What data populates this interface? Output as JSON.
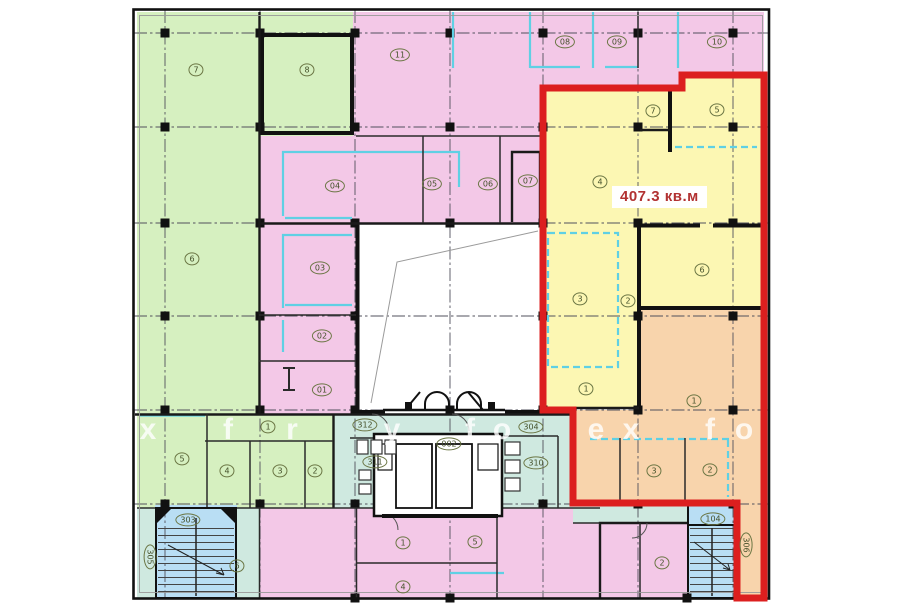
{
  "plan": {
    "title": "floor-plan",
    "area_highlight": {
      "text": "407.3 кв.м",
      "value": "407.3",
      "unit": "кв.м"
    }
  },
  "zones": [
    {
      "name": "green-offices",
      "color": "#d6f0c0"
    },
    {
      "name": "pink-offices",
      "color": "#f3c8e7"
    },
    {
      "name": "yellow-highlight",
      "color": "#fcf7b3"
    },
    {
      "name": "orange-highlight",
      "color": "#f8d4ac"
    },
    {
      "name": "teal-corridor",
      "color": "#cfe9e0"
    },
    {
      "name": "blue-stairwell",
      "color": "#b9def4"
    },
    {
      "name": "highlight-outline",
      "color": "#dc1f1f"
    },
    {
      "name": "partition-lines",
      "color": "#5fd0e4"
    }
  ],
  "rooms": [
    {
      "label": "7",
      "x": 196,
      "y": 70,
      "zone": "green"
    },
    {
      "label": "8",
      "x": 307,
      "y": 70,
      "zone": "green"
    },
    {
      "label": "6",
      "x": 192,
      "y": 259,
      "zone": "green"
    },
    {
      "label": "11",
      "x": 400,
      "y": 55,
      "zone": "pink"
    },
    {
      "label": "08",
      "x": 565,
      "y": 42,
      "zone": "pink"
    },
    {
      "label": "09",
      "x": 617,
      "y": 42,
      "zone": "pink"
    },
    {
      "label": "10",
      "x": 717,
      "y": 42,
      "zone": "pink"
    },
    {
      "label": "04",
      "x": 335,
      "y": 186,
      "zone": "pink"
    },
    {
      "label": "05",
      "x": 432,
      "y": 184,
      "zone": "pink"
    },
    {
      "label": "06",
      "x": 488,
      "y": 184,
      "zone": "pink"
    },
    {
      "label": "07",
      "x": 528,
      "y": 181,
      "zone": "pink"
    },
    {
      "label": "03",
      "x": 320,
      "y": 268,
      "zone": "pink"
    },
    {
      "label": "02",
      "x": 322,
      "y": 336,
      "zone": "pink"
    },
    {
      "label": "01",
      "x": 322,
      "y": 390,
      "zone": "pink"
    },
    {
      "label": "4",
      "x": 600,
      "y": 182,
      "zone": "yellow"
    },
    {
      "label": "7",
      "x": 653,
      "y": 111,
      "zone": "yellow"
    },
    {
      "label": "5",
      "x": 717,
      "y": 110,
      "zone": "yellow"
    },
    {
      "label": "6",
      "x": 702,
      "y": 270,
      "zone": "yellow"
    },
    {
      "label": "3",
      "x": 580,
      "y": 299,
      "zone": "yellow"
    },
    {
      "label": "2",
      "x": 628,
      "y": 301,
      "zone": "yellow"
    },
    {
      "label": "1",
      "x": 586,
      "y": 389,
      "zone": "yellow"
    },
    {
      "label": "1",
      "x": 694,
      "y": 401,
      "zone": "orange"
    },
    {
      "label": "3",
      "x": 654,
      "y": 471,
      "zone": "orange"
    },
    {
      "label": "2",
      "x": 710,
      "y": 470,
      "zone": "orange"
    },
    {
      "label": "1",
      "x": 268,
      "y": 427,
      "zone": "green"
    },
    {
      "label": "5",
      "x": 182,
      "y": 459,
      "zone": "green"
    },
    {
      "label": "4",
      "x": 227,
      "y": 471,
      "zone": "green"
    },
    {
      "label": "3",
      "x": 280,
      "y": 471,
      "zone": "green"
    },
    {
      "label": "2",
      "x": 315,
      "y": 471,
      "zone": "green"
    },
    {
      "label": "312",
      "x": 365,
      "y": 425,
      "zone": "teal"
    },
    {
      "label": "304",
      "x": 531,
      "y": 427,
      "zone": "teal"
    },
    {
      "label": "002",
      "x": 449,
      "y": 444,
      "zone": "teal"
    },
    {
      "label": "311",
      "x": 375,
      "y": 462,
      "zone": "teal"
    },
    {
      "label": "310",
      "x": 536,
      "y": 463,
      "zone": "teal"
    },
    {
      "label": "303",
      "x": 188,
      "y": 520,
      "zone": "stair"
    },
    {
      "label": "104",
      "x": 713,
      "y": 519,
      "zone": "stair"
    },
    {
      "label": "305",
      "x": 150,
      "y": 557,
      "zone": "teal",
      "rot": 90
    },
    {
      "label": "306",
      "x": 746,
      "y": 545,
      "zone": "orange",
      "rot": 90
    },
    {
      "label": "6",
      "x": 237,
      "y": 566,
      "zone": "pink"
    },
    {
      "label": "1",
      "x": 403,
      "y": 543,
      "zone": "pink"
    },
    {
      "label": "5",
      "x": 475,
      "y": 542,
      "zone": "pink"
    },
    {
      "label": "4",
      "x": 403,
      "y": 587,
      "zone": "pink"
    },
    {
      "label": "2",
      "x": 662,
      "y": 563,
      "zone": "pink"
    }
  ],
  "watermark": {
    "y": 430,
    "letters": [
      {
        "ch": "x",
        "x": 148
      },
      {
        "ch": "f",
        "x": 228
      },
      {
        "ch": "r",
        "x": 292
      },
      {
        "ch": "y",
        "x": 392
      },
      {
        "ch": "f",
        "x": 470
      },
      {
        "ch": "o",
        "x": 502
      },
      {
        "ch": "e",
        "x": 596
      },
      {
        "ch": "x",
        "x": 631
      },
      {
        "ch": "f",
        "x": 710
      },
      {
        "ch": "o",
        "x": 744
      }
    ]
  }
}
